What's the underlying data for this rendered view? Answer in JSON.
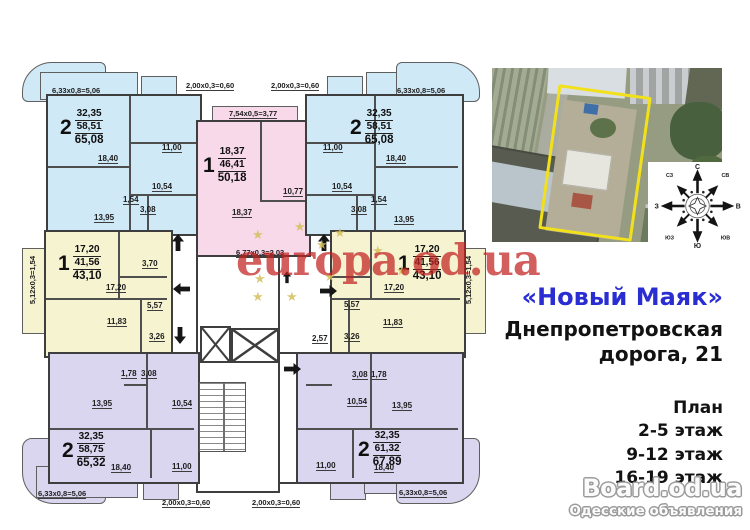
{
  "plan": {
    "watermark": "europa.od.ua",
    "star": "★",
    "apartments": {
      "top_left": {
        "rooms": "2",
        "area1": "32,35",
        "area2": "58,51",
        "area3": "65,08"
      },
      "top_mid": {
        "rooms": "1",
        "area1": "18,37",
        "area2": "46,41",
        "area3": "50,18"
      },
      "top_right": {
        "rooms": "2",
        "area1": "32,35",
        "area2": "58,51",
        "area3": "65,08"
      },
      "mid_left": {
        "rooms": "1",
        "area1": "17,20",
        "area2": "41,56",
        "area3": "43,10"
      },
      "mid_right": {
        "rooms": "1",
        "area1": "17,20",
        "area2": "41,56",
        "area3": "43,10"
      },
      "bottom_left": {
        "rooms": "2",
        "area1": "32,35",
        "area2": "58,75",
        "area3": "65,32"
      },
      "bottom_right": {
        "rooms": "2",
        "area1": "32,35",
        "area2": "61,32",
        "area3": "67,89"
      }
    },
    "rooms": {
      "tl": {
        "living": "18,40",
        "kitchen": "11,00",
        "hall": "10,54",
        "wc": "1,54",
        "bath": "3,08",
        "bedroom": "13,95"
      },
      "tm": {
        "kitchen": "10,77",
        "living": "18,37"
      },
      "tr": {
        "living": "18,40",
        "kitchen": "11,00",
        "hall": "10,54",
        "wc": "1,54",
        "bath": "3,08",
        "bedroom": "13,95"
      },
      "ml": {
        "living": "17,20",
        "bath": "3,70",
        "hall": "5,57",
        "kitchen": "11,83",
        "entry": "3,26"
      },
      "mr": {
        "living": "17,20",
        "hall": "5,57",
        "kitchen": "11,83",
        "entry": "3,26",
        "lobby": "2,57"
      },
      "bl": {
        "bedroom": "13,95",
        "hall": "10,54",
        "living": "18,40",
        "kitchen": "11,00",
        "wc": "1,78",
        "bath": "3,08"
      },
      "br": {
        "hall": "10,54",
        "bedroom": "13,95",
        "kitchen": "11,00",
        "living": "18,40",
        "bath": "3,08",
        "wc": "1,78"
      }
    },
    "dims": {
      "d633": "6,33x0,8=5,06",
      "d200": "2,00x0,3=0,60",
      "d754": "7,54x0,5=3,77",
      "d677": "6,77x0,3=2,03",
      "d512": "5,12x0,3=1,54"
    }
  },
  "sidebar": {
    "title": "«Новый Маяк»",
    "address_line1": "Днепропетровская",
    "address_line2": "дорога, 21",
    "plan_heading": "План",
    "floors": [
      "2-5 этаж",
      "9-12 этаж",
      "16-19 этаж"
    ]
  },
  "footer": {
    "logo": "Board.od.ua",
    "tagline": "Одесские объявления"
  },
  "compass": {
    "n": "С",
    "ne": "СВ",
    "e": "В",
    "se": "ЮВ",
    "s": "Ю",
    "sw": "ЮЗ",
    "w": "З",
    "nw": "СЗ"
  },
  "colors": {
    "apartment_blue": "#cfe9f6",
    "apartment_pink": "#f8d9ea",
    "apartment_yellow": "#f6f3d1",
    "apartment_lavender": "#dad6f0",
    "watermark_red": "#c02020",
    "title_blue": "#2a2ed2",
    "site_outline_yellow": "#f2e11a"
  }
}
